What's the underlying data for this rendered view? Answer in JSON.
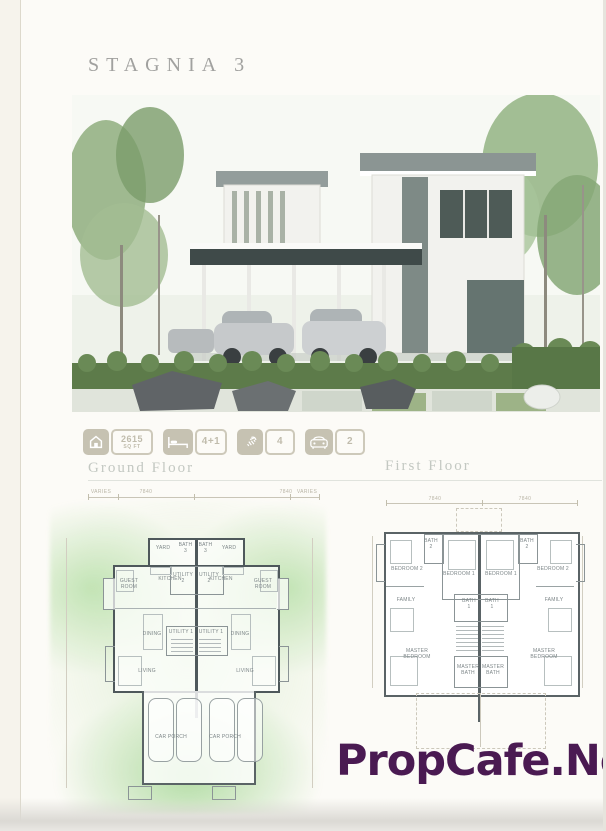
{
  "page": {
    "title": "STAGNIA 3",
    "watermark": "PropCafe.Net"
  },
  "specs": [
    {
      "icon": "house-area-icon",
      "value": "2615",
      "unit": "SQ FT"
    },
    {
      "icon": "bed-icon",
      "value": "4+1"
    },
    {
      "icon": "shower-icon",
      "value": "4"
    },
    {
      "icon": "car-icon",
      "value": "2"
    }
  ],
  "floors": {
    "ground": {
      "label": "Ground Floor",
      "dims": [
        "VARIES",
        "7840",
        "7840",
        "VARIES"
      ],
      "rooms": {
        "yard_left": "YARD",
        "bath3_left": "BATH 3",
        "bath3_right": "BATH 3",
        "yard_right": "YARD",
        "guest_left": "GUEST ROOM",
        "kitchen_left": "KITCHEN",
        "utility2_left": "UTILITY 2",
        "utility2_right": "UTILITY 2",
        "kitchen_right": "KITCHEN",
        "guest_right": "GUEST ROOM",
        "dining_left": "DINING",
        "utility1_left": "UTILITY 1",
        "utility1_right": "UTILITY 1",
        "dining_right": "DINING",
        "living_left": "LIVING",
        "living_right": "LIVING",
        "carporch_left": "CAR PORCH",
        "carporch_right": "CAR PORCH"
      }
    },
    "first": {
      "label": "First Floor",
      "dims": [
        "7840",
        "7840"
      ],
      "rooms": {
        "bath2_left": "BATH 2",
        "bedroom1_left": "BEDROOM 1",
        "bedroom1_right": "BEDROOM 1",
        "bath2_right": "BATH 2",
        "bedroom2_left": "BEDROOM 2",
        "bedroom2_right": "BEDROOM 2",
        "family_left": "FAMILY",
        "bath1_left": "BATH 1",
        "bath1_right": "BATH 1",
        "family_right": "FAMILY",
        "master_left": "MASTER BEDROOM",
        "masterbath_left": "MASTER BATH",
        "masterbath_right": "MASTER BATH",
        "master_right": "MASTER BEDROOM"
      }
    }
  },
  "colors": {
    "watermark": "#4a1a52",
    "badge_fill": "#c6c2b2",
    "plan_wall": "#4e585b",
    "glow_green": "#cdeac4"
  }
}
